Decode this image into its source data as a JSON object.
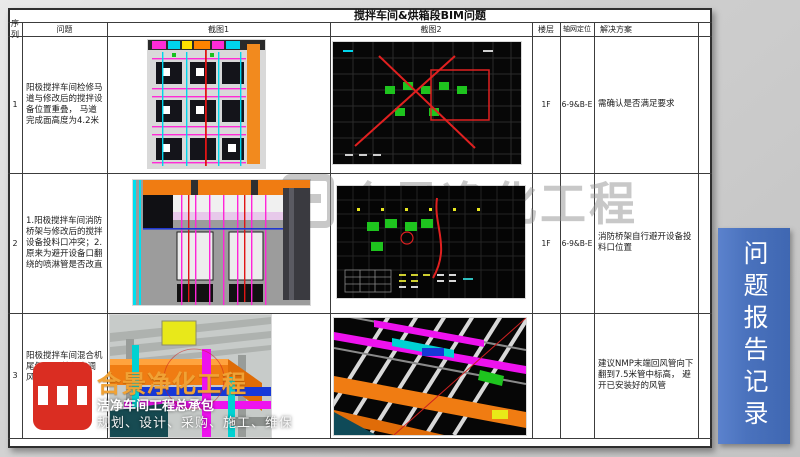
{
  "table": {
    "title": "搅拌车间&烘箱段BIM问题",
    "columns": [
      "序列",
      "问题",
      "截图1",
      "截图2",
      "楼层",
      "轴网定位",
      "解决方案"
    ],
    "rows": [
      {
        "seq": "1",
        "problem": "阳极搅拌车间检修马道与修改后的搅拌设备位置重叠， 马道完成面高度为4.2米",
        "floor": "1F",
        "axis": "6-9&B-E",
        "solution": "需确认是否满足要求"
      },
      {
        "seq": "2",
        "problem": "1.阳极搅拌车间消防桥架与修改后的搅拌设备投料口冲突；2.原来为避开设备口翻绕的喷淋管是否改直",
        "floor": "1F",
        "axis": "6-9&B-E",
        "solution": "消防桥架自行避开设备投料口位置"
      },
      {
        "seq": "3",
        "problem": "阳极搅拌车间混合机尾气NMP管与空调风管冲突",
        "floor": "",
        "axis": "",
        "solution": "建议NMP末端回风管向下翻到7.5米管中标高， 避开已安装好的风管"
      }
    ]
  },
  "banner": {
    "text": "问题报告记录",
    "color": "#4a72bd"
  },
  "logo": {
    "icon": "cj-monogram-icon",
    "brand": "合景净化工程",
    "tagline1": "洁净车间工程总承包",
    "tagline2": "规划、设计、采购、施工、维保"
  },
  "watermark": {
    "text": "合景净化工程"
  },
  "colors": {
    "banner_blue": "#4a72bd",
    "logo_red": "#da2d22",
    "brand_orange": "#f0a235"
  }
}
